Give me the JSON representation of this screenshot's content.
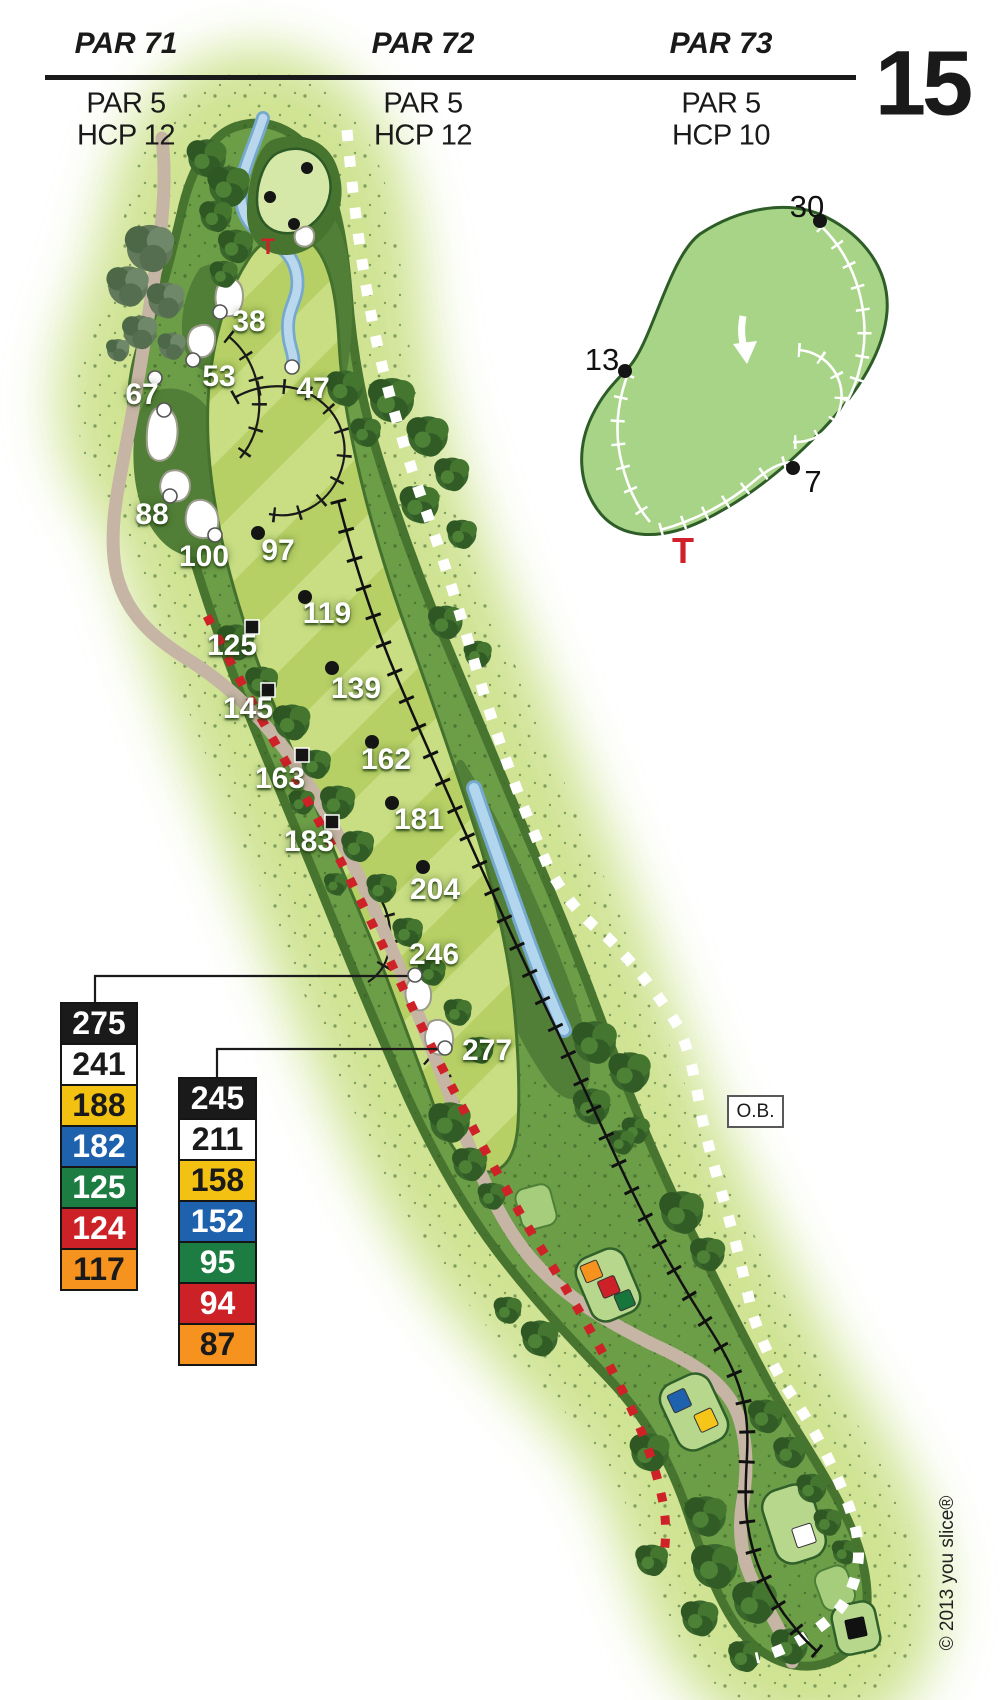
{
  "header": {
    "hole_number": "15",
    "columns": [
      {
        "course_par": "PAR 71",
        "hole_par": "PAR 5",
        "handicap": "HCP 12"
      },
      {
        "course_par": "PAR 72",
        "hole_par": "PAR 5",
        "handicap": "HCP 12"
      },
      {
        "course_par": "PAR 73",
        "hole_par": "PAR 5",
        "handicap": "HCP 10"
      }
    ]
  },
  "map": {
    "distance_labels": [
      "38",
      "53",
      "67",
      "47",
      "88",
      "100",
      "97",
      "119",
      "125",
      "139",
      "145",
      "162",
      "163",
      "181",
      "183",
      "204",
      "246",
      "277"
    ],
    "ob_label": "O.B.",
    "tee_symbol": "T",
    "tee_marker_colors": {
      "orange": "#f6921e",
      "red": "#cc2127",
      "green": "#17763c",
      "blue": "#1e62ae",
      "yellow": "#f5c51a",
      "white": "#ffffff",
      "black": "#111111"
    }
  },
  "green_inset": {
    "depth_back": "30",
    "depth_left": "13",
    "depth_front": "7",
    "tee_symbol": "T"
  },
  "distance_tables": {
    "left": {
      "rows": [
        {
          "value": "275",
          "tee": "black"
        },
        {
          "value": "241",
          "tee": "white"
        },
        {
          "value": "188",
          "tee": "yellow"
        },
        {
          "value": "182",
          "tee": "blue"
        },
        {
          "value": "125",
          "tee": "green"
        },
        {
          "value": "124",
          "tee": "red"
        },
        {
          "value": "117",
          "tee": "orange"
        }
      ]
    },
    "right": {
      "rows": [
        {
          "value": "245",
          "tee": "black"
        },
        {
          "value": "211",
          "tee": "white"
        },
        {
          "value": "158",
          "tee": "yellow"
        },
        {
          "value": "152",
          "tee": "blue"
        },
        {
          "value": "95",
          "tee": "green"
        },
        {
          "value": "94",
          "tee": "red"
        },
        {
          "value": "87",
          "tee": "orange"
        }
      ]
    }
  },
  "copyright": "© 2013 you slice®",
  "colors": {
    "fairway_light": "#c9de82",
    "fairway_dark": "#b6d065",
    "rough": "#6c9d47",
    "rough_dark": "#527f37",
    "tree_dark": "#2e5723",
    "halo": "#cde28e",
    "water": "#b2d6ee",
    "cart_path": "#c6b5a5",
    "hazard_red": "#cf2128",
    "green_inset_fill": "#a7d487"
  }
}
